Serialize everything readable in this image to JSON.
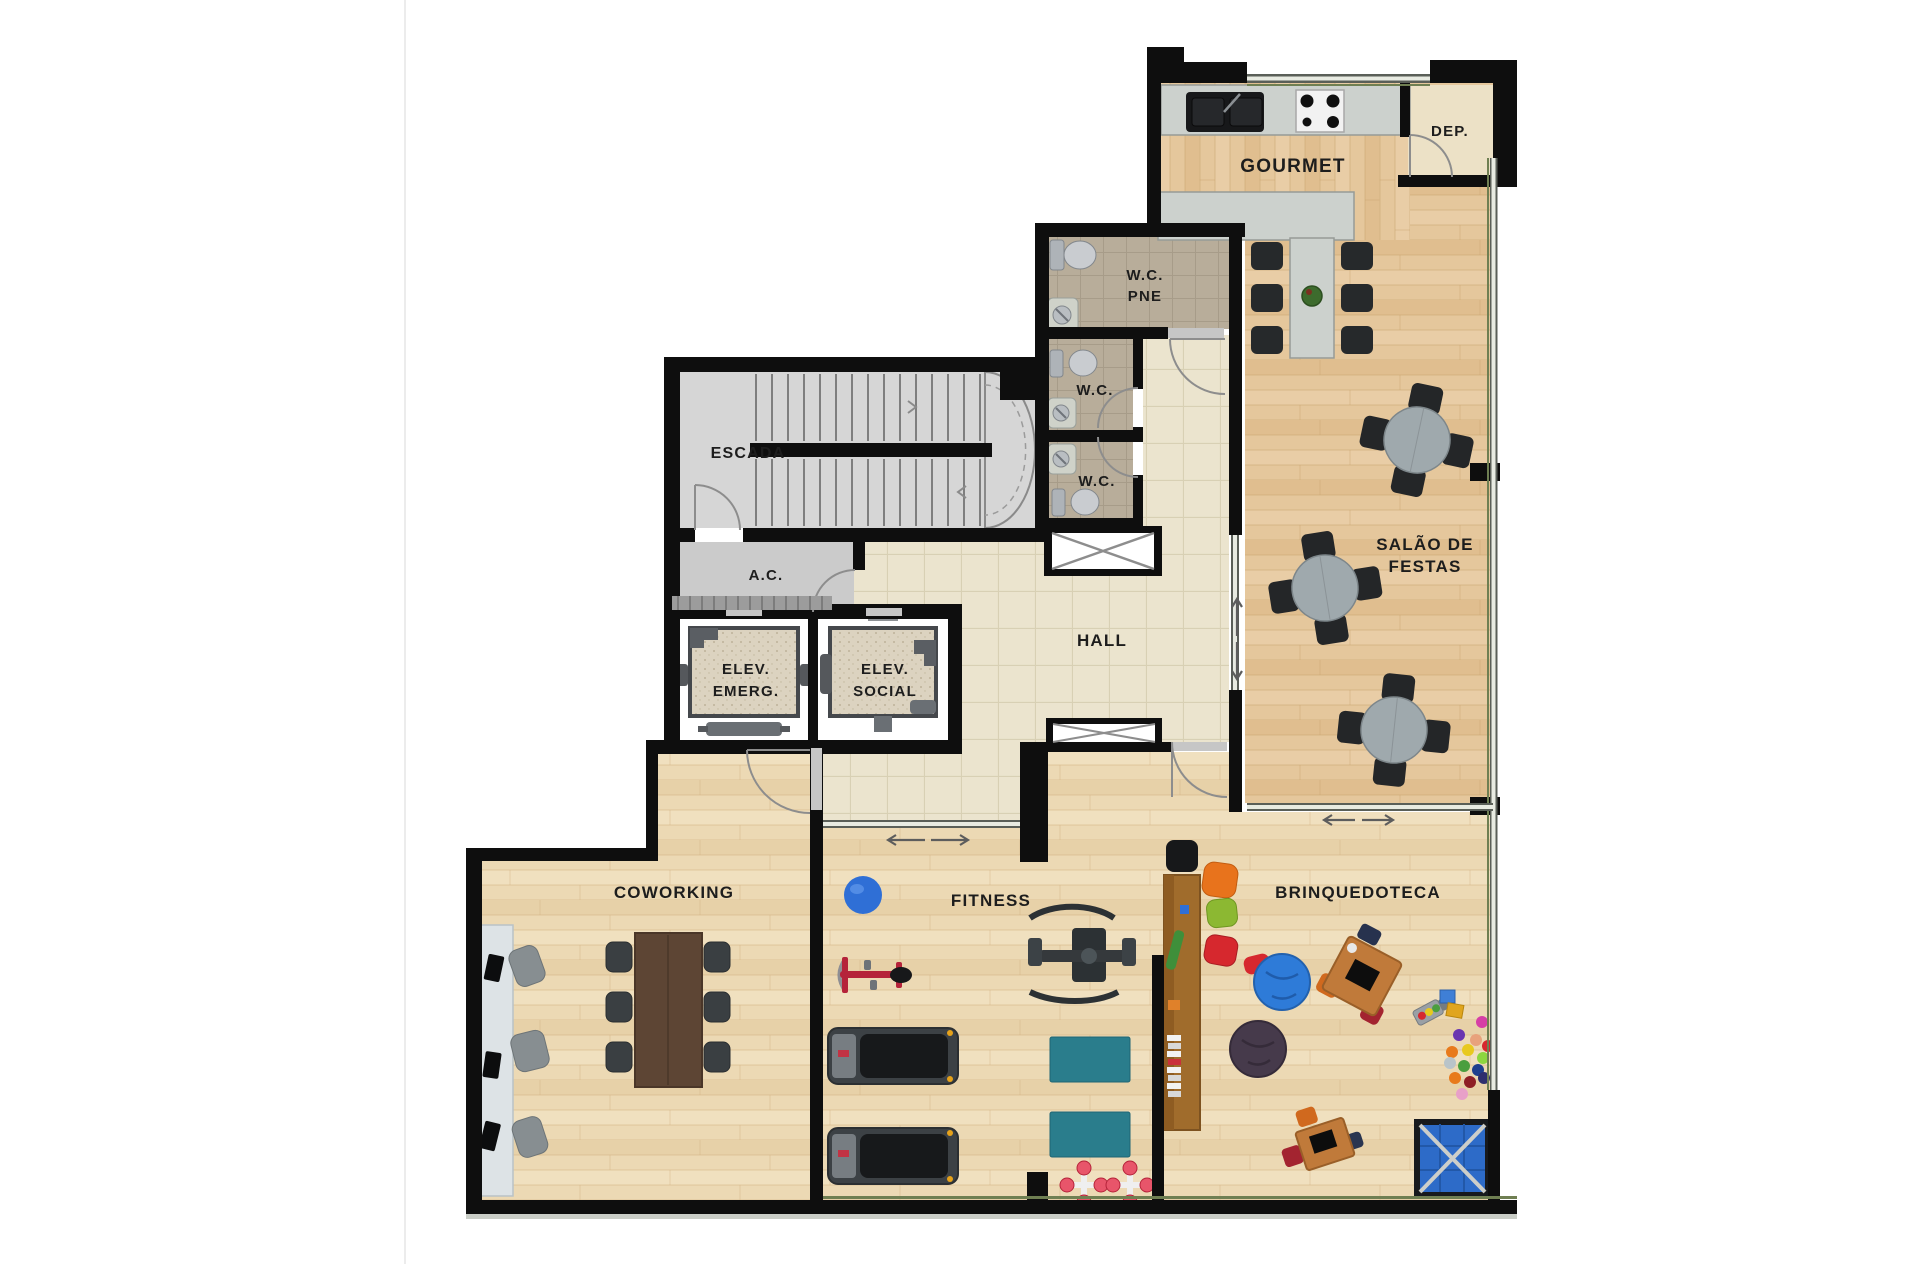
{
  "document": {
    "type": "architectural-floor-plan",
    "background": "#ffffff"
  },
  "labels": {
    "gourmet": "GOURMET",
    "dep": "DEP.",
    "wc_pne_line1": "W.C.",
    "wc_pne_line2": "PNE",
    "wc_middle": "W.C.",
    "wc_lower": "W.C.",
    "escada": "ESCADA",
    "ac": "A.C.",
    "elev_emerg_line1": "ELEV.",
    "elev_emerg_line2": "EMERG.",
    "elev_social_line1": "ELEV.",
    "elev_social_line2": "SOCIAL",
    "hall": "HALL",
    "salao_line1": "SALÃO DE",
    "salao_line2": "FESTAS",
    "coworking": "COWORKING",
    "fitness": "FITNESS",
    "brinquedoteca": "BRINQUEDOTECA"
  },
  "palette": {
    "wall": "#0e0e0e",
    "wood_warm": "#e5c79c",
    "wood_light": "#ecd9b4",
    "hall_tile": "#ebe4ce",
    "wc_tile": "#b8ad9a",
    "stair_floor": "#d6d6d6",
    "ac_floor": "#cbcbcb",
    "granite": "#ccd1cd",
    "elevator_floor": "#dcd3c0",
    "window_green": "#6f7f52",
    "teal_mat": "#2a7d8c",
    "blue_accent": "#2f6fd6",
    "red_accent": "#b5233a",
    "kids_wood": "#c07a3a",
    "dark_table_wood": "#5d4534"
  }
}
